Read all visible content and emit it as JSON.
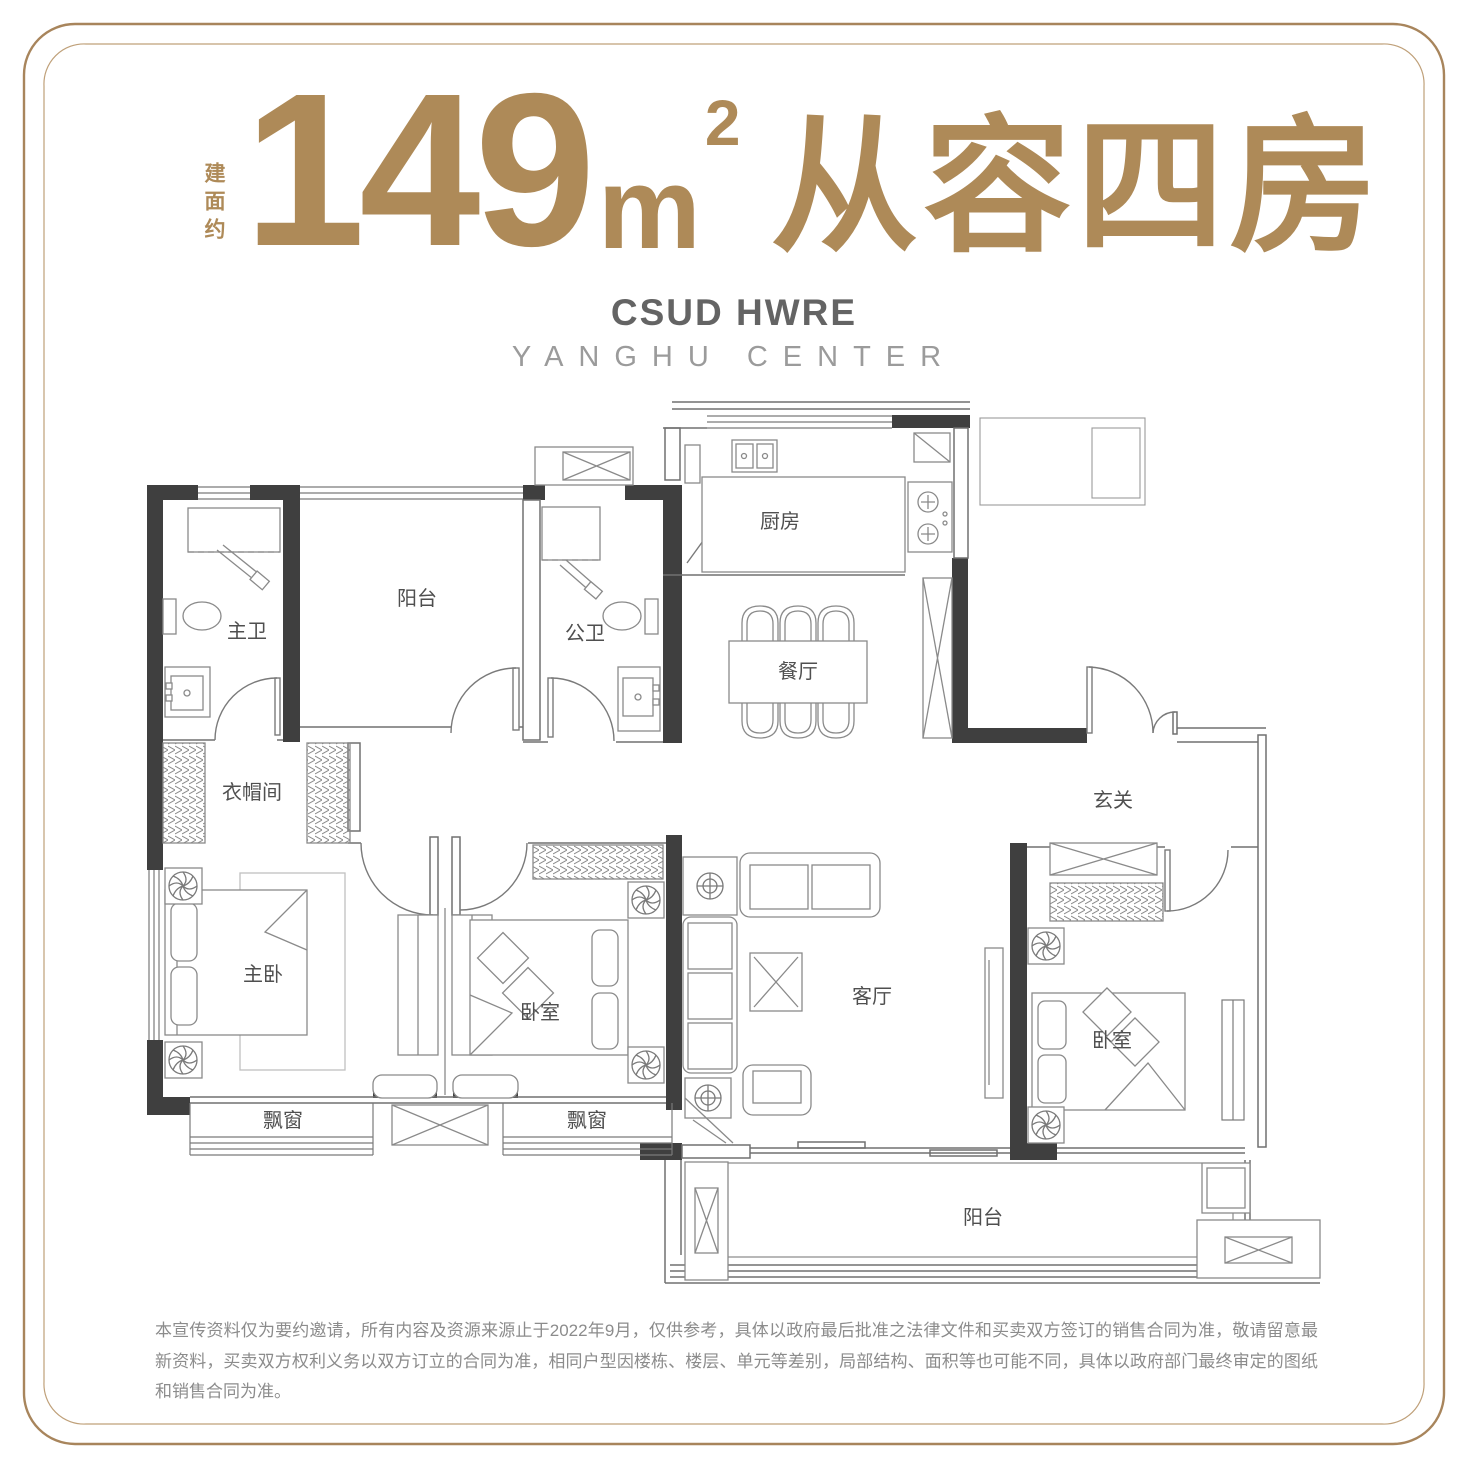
{
  "header": {
    "area_label": "建面约",
    "title_number": "149",
    "title_unit": "m",
    "title_sup": "2",
    "title_suffix": "从容四房",
    "brand": "CSUD HWRE",
    "brand_sub": "YANGHU CENTER",
    "accent_color": "#ae8a58"
  },
  "floorplan": {
    "rooms": {
      "master_bath": "主卫",
      "balcony_top": "阳台",
      "guest_bath": "公卫",
      "kitchen": "厨房",
      "dining": "餐厅",
      "foyer": "玄关",
      "cloakroom": "衣帽间",
      "master_bedroom": "主卧",
      "bedroom_mid": "卧室",
      "living": "客厅",
      "bedroom_right": "卧室",
      "bay_window_left": "飘窗",
      "bay_window_right": "飘窗",
      "balcony_bottom": "阳台"
    },
    "wall_color": "#3f3f3f",
    "line_color": "#707070"
  },
  "footer": {
    "disclaimer": "本宣传资料仅为要约邀请，所有内容及资源来源止于2022年9月，仅供参考，具体以政府最后批准之法律文件和买卖双方签订的销售合同为准，敬请留意最新资料，买卖双方权利义务以双方订立的合同为准，相同户型因楼栋、楼层、单元等差别，局部结构、面积等也可能不同，具体以政府部门最终审定的图纸和销售合同为准。"
  }
}
